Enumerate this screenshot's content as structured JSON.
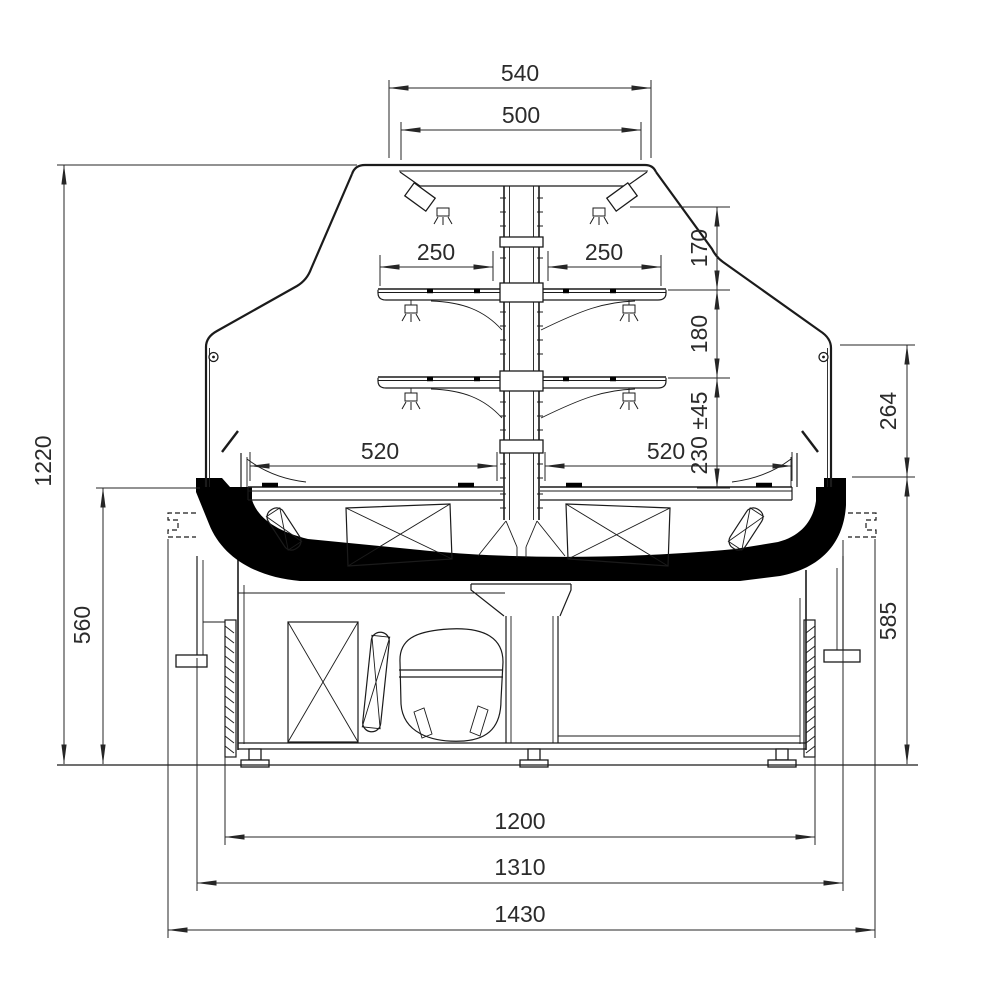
{
  "drawing": {
    "type": "technical-cross-section",
    "subject": "refrigerated serve-over display counter, side section with dimensions (mm)",
    "colors": {
      "line": "#1b1b1b",
      "text": "#2b2b2b",
      "insulation_fill": "#000000",
      "background": "#ffffff"
    },
    "dimensions": {
      "canopy_overall_width": "540",
      "canopy_inner_width": "500",
      "upper_shelf_left_depth": "250",
      "upper_shelf_right_depth": "250",
      "canopy_to_upper_shelf": "170",
      "upper_to_lower_shelf": "180",
      "lower_shelf_to_deck": "230 ±45",
      "front_glass_height": "264",
      "deck_left_depth": "520",
      "deck_right_depth": "520",
      "overall_height": "1220",
      "counter_height": "560",
      "front_panel_height": "585",
      "base_width": "1200",
      "body_width": "1310",
      "overall_width": "1430"
    }
  }
}
